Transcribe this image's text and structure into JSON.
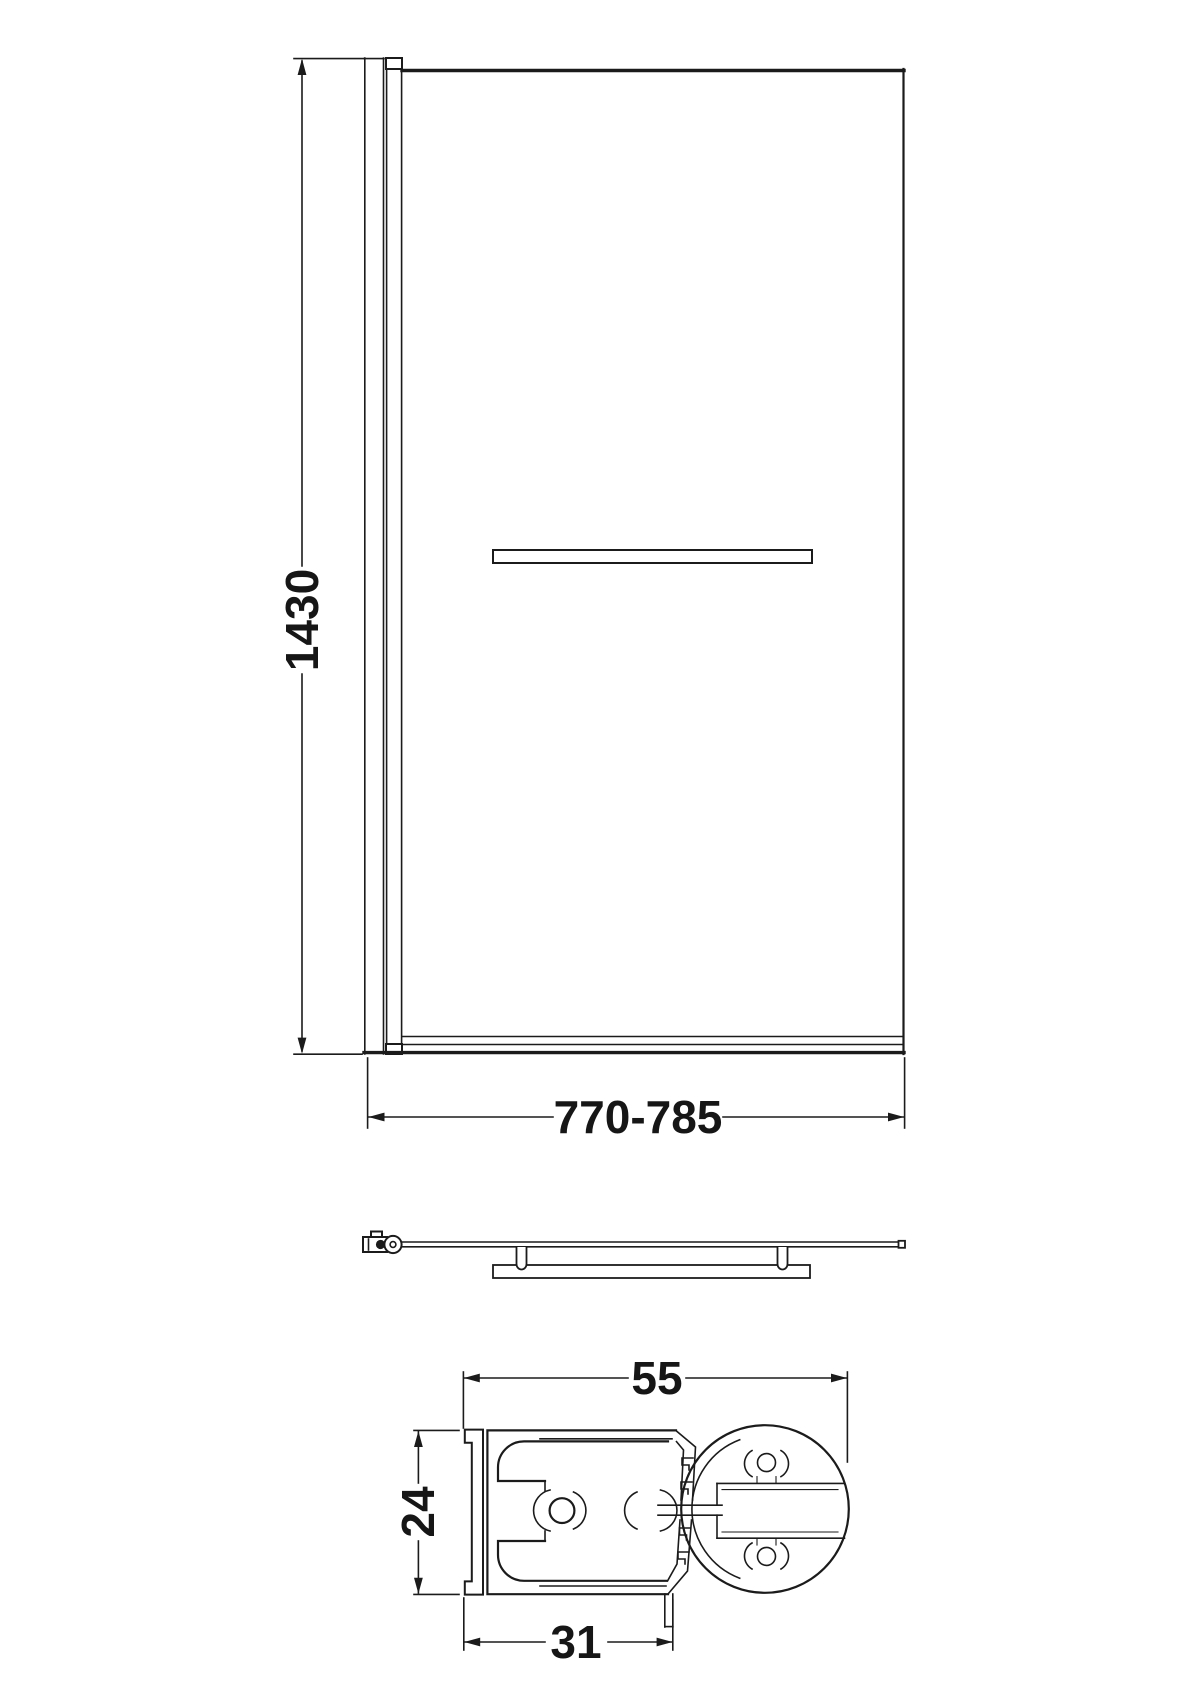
{
  "drawing": {
    "background_color": "#ffffff",
    "line_color": "#1b1b1b",
    "front_view": {
      "height_label": "1430",
      "width_label": "770-785"
    },
    "section_view": {
      "width_label": "55",
      "depth_label": "24",
      "channel_label": "31"
    }
  }
}
